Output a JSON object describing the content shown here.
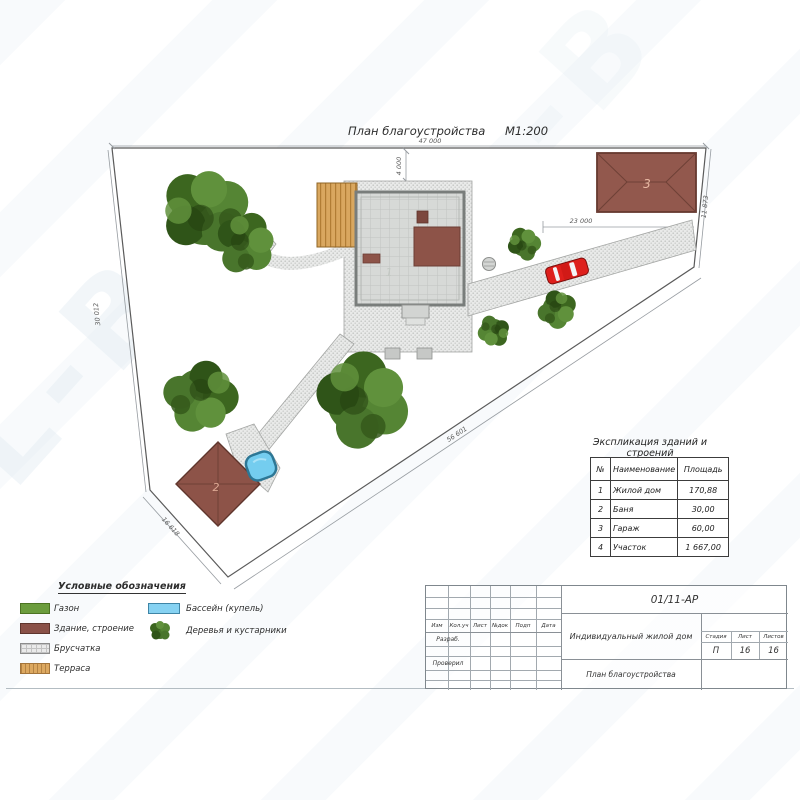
{
  "page": {
    "title": "План благоустройства",
    "scale": "М1:200"
  },
  "watermark": {
    "text": "L-B"
  },
  "plan": {
    "dimensions": {
      "top": "47 000",
      "house_offset": "4 000",
      "garage_width": "23 000",
      "right": "11 873",
      "left": "30 012",
      "diagonal": "56 601",
      "bottom_left": "16 618"
    },
    "labels": {
      "house": "1",
      "bathhouse": "2",
      "garage": "3"
    }
  },
  "legend": {
    "title": "Условные обозначения",
    "items": [
      {
        "label": "Газон",
        "icon": "lawn-swatch",
        "color": "#6b9c3d"
      },
      {
        "label": "Здание, строение",
        "icon": "building-swatch",
        "color": "#8a5148"
      },
      {
        "label": "Брусчатка",
        "icon": "paving-swatch",
        "color": "#eaeaea"
      },
      {
        "label": "Терраса",
        "icon": "terrace-swatch",
        "color": "#dca860"
      },
      {
        "label": "Бассейн (купель)",
        "icon": "pool-swatch",
        "color": "#86d2f2"
      },
      {
        "label": "Деревья и кустарники",
        "icon": "tree-icon",
        "color": "#49752c"
      }
    ]
  },
  "explication": {
    "title": "Экспликация зданий и строений",
    "headers": [
      "№",
      "Наименование",
      "Площадь"
    ],
    "rows": [
      [
        "1",
        "Жилой дом",
        "170,88"
      ],
      [
        "2",
        "Баня",
        "30,00"
      ],
      [
        "3",
        "Гараж",
        "60,00"
      ],
      [
        "4",
        "Участок",
        "1 667,00"
      ]
    ]
  },
  "titleblock": {
    "doc_number": "01/11-АР",
    "header_cells": [
      "Изм",
      "Кол.уч",
      "Лист",
      "№док",
      "Подп",
      "Дата"
    ],
    "row_labels": [
      "Разраб.",
      "Проверил"
    ],
    "project_name": "Индивидуальный жилой дом",
    "sheet_name": "План благоустройства",
    "stage_label": "Стадия",
    "stage": "П",
    "sheet_label": "Лист",
    "sheet": "16",
    "sheets_label": "Листов",
    "sheets": "16"
  }
}
